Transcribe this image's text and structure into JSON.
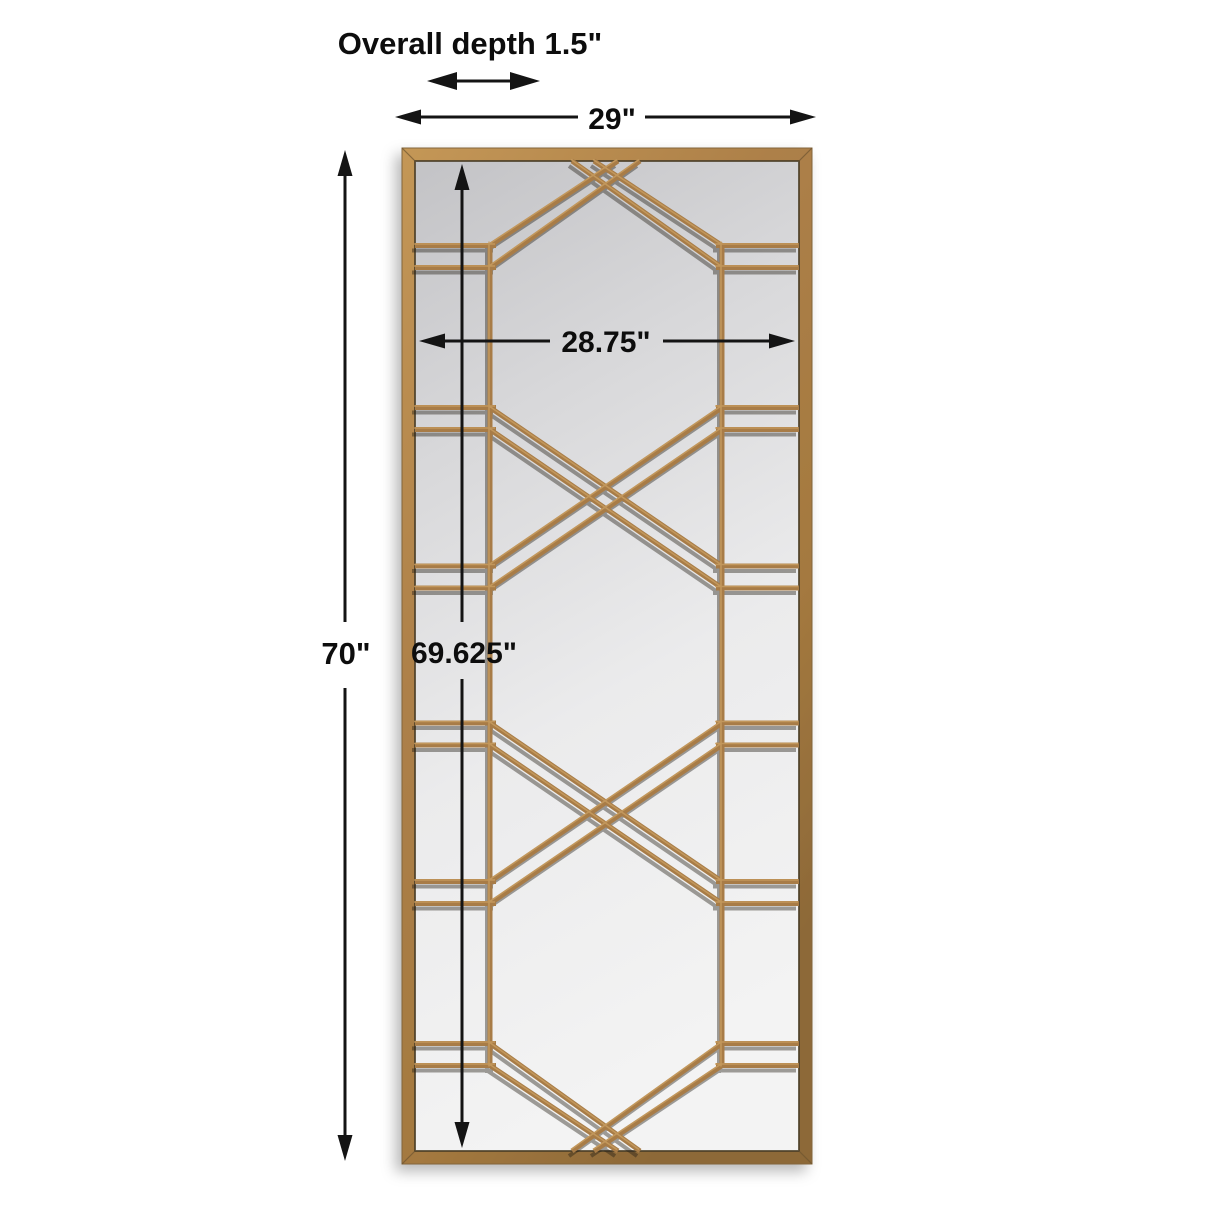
{
  "figure": {
    "description": "Tall rectangular leaner mirror with antique gold metal frame and geometric criss-cross fretwork overlay on mirror glass",
    "colors": {
      "frame_gold": "#a87c46",
      "frame_gold_light": "#c79a5c",
      "frame_gold_dark": "#8d6938",
      "glass_gray": "#dcdcde",
      "annotation_black": "#141414",
      "background": "#ffffff"
    }
  },
  "dimensions": {
    "overall_depth": {
      "label": "Overall depth 1.5\""
    },
    "overall_width": {
      "label": "29\""
    },
    "inner_width": {
      "label": "28.75\""
    },
    "overall_height": {
      "label": "70\""
    },
    "inner_height": {
      "label": "69.625\""
    }
  }
}
